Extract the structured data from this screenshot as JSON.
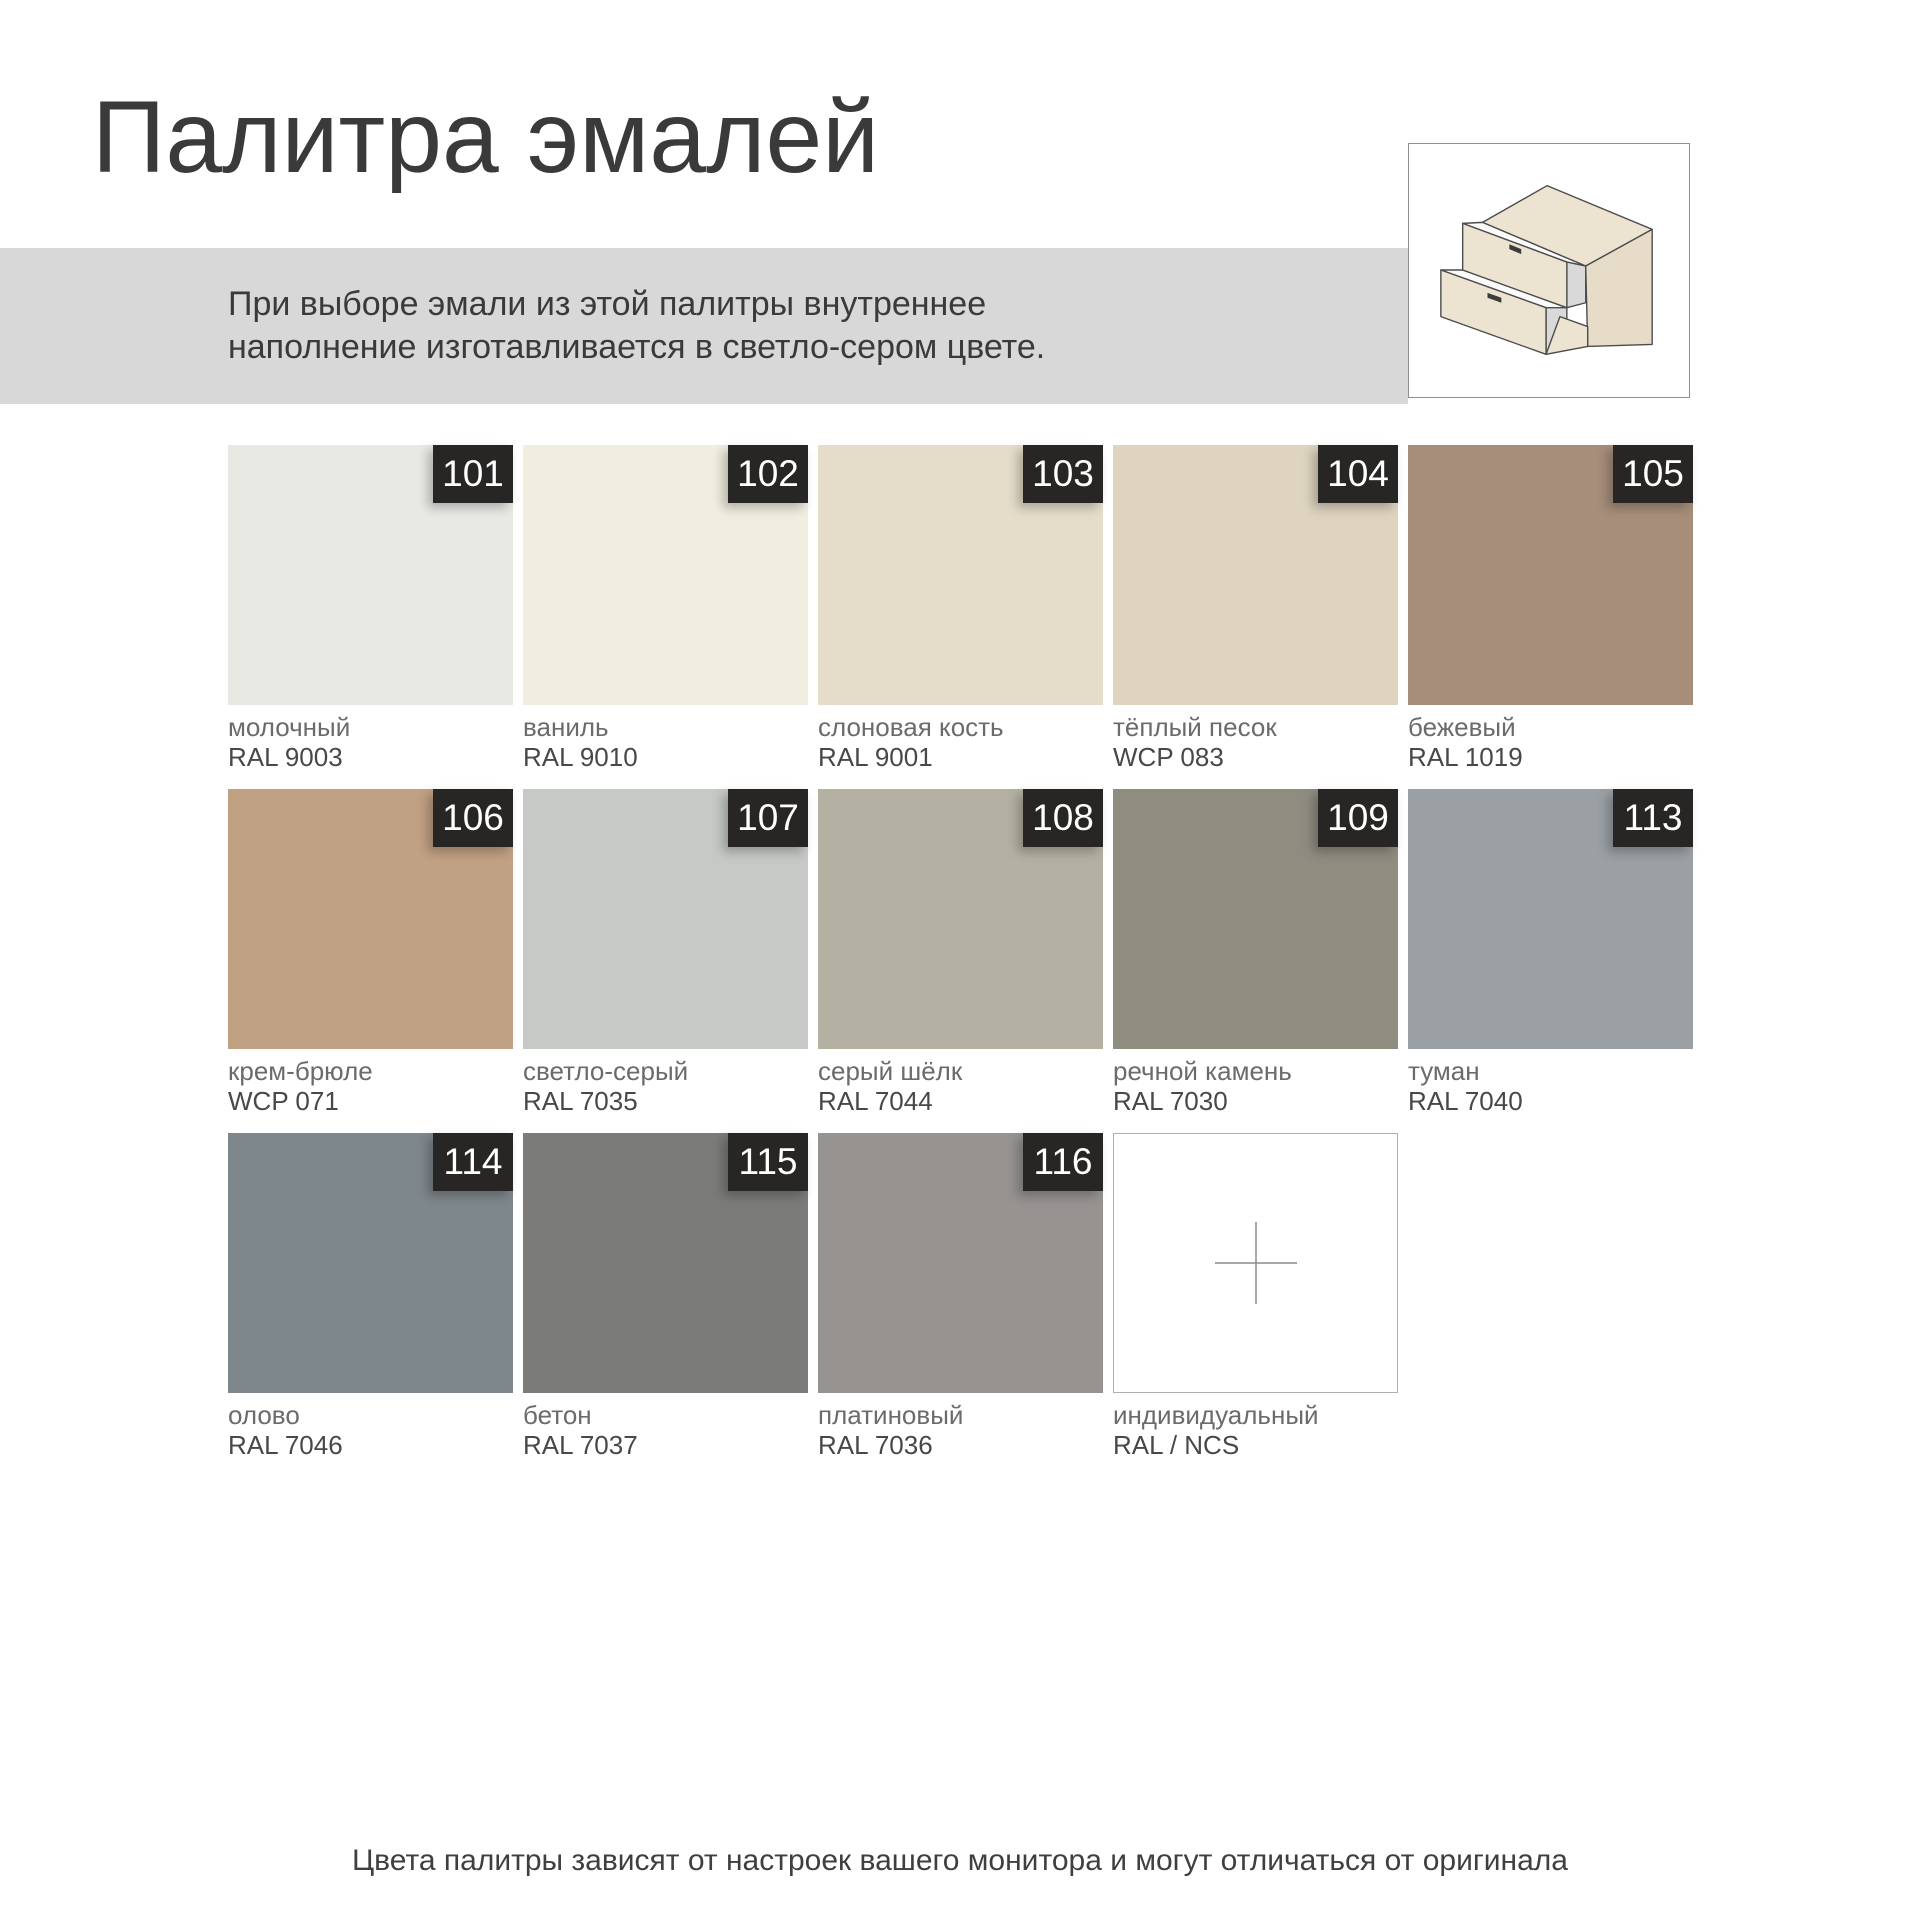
{
  "page": {
    "title": "Палитра эмалей",
    "note_line1": "При выборе эмали из этой палитры внутреннее",
    "note_line2": "наполнение изготавливается в светло-сером цвете.",
    "footer": "Цвета палитры зависят от настроек вашего монитора и могут отличаться от оригинала"
  },
  "colors": {
    "banner_bg": "#d8d8d8",
    "badge_bg": "#272625",
    "badge_text": "#ffffff",
    "title_text": "#3a3a3a",
    "name_text": "#6b6b6b",
    "code_text": "#484848",
    "custom_border": "#aeaeae",
    "plus_line": "#8a8a8a",
    "illustration_outline": "#4c4c4c",
    "illustration_wood": "#ece3d1"
  },
  "illustration": {
    "icon": "two-drawer-cabinet"
  },
  "swatches": [
    {
      "num": "101",
      "name": "молочный",
      "code": "RAL 9003",
      "hex": "#e9e9e4"
    },
    {
      "num": "102",
      "name": "ваниль",
      "code": "RAL 9010",
      "hex": "#f1ede1"
    },
    {
      "num": "103",
      "name": "слоновая кость",
      "code": "RAL 9001",
      "hex": "#e5ddca"
    },
    {
      "num": "104",
      "name": "тёплый песок",
      "code": "WCP 083",
      "hex": "#ded4bf"
    },
    {
      "num": "105",
      "name": "бежевый",
      "code": "RAL 1019",
      "hex": "#a68e7a"
    },
    {
      "num": "106",
      "name": "крем-брюле",
      "code": "WCP 071",
      "hex": "#c1a184"
    },
    {
      "num": "107",
      "name": "светло-серый",
      "code": "RAL 7035",
      "hex": "#c6c9c5"
    },
    {
      "num": "108",
      "name": "серый шёлк",
      "code": "RAL 7044",
      "hex": "#b4b1a3"
    },
    {
      "num": "109",
      "name": "речной камень",
      "code": "RAL 7030",
      "hex": "#8f8d80"
    },
    {
      "num": "113",
      "name": "туман",
      "code": "RAL 7040",
      "hex": "#9aa0a4"
    },
    {
      "num": "114",
      "name": "олово",
      "code": "RAL 7046",
      "hex": "#7e878c"
    },
    {
      "num": "115",
      "name": "бетон",
      "code": "RAL 7037",
      "hex": "#7b7b7a"
    },
    {
      "num": "116",
      "name": "платиновый",
      "code": "RAL 7036",
      "hex": "#969391"
    },
    {
      "num": null,
      "name": "индивидуальный",
      "code": "RAL / NCS",
      "hex": "#ffffff",
      "custom": true
    }
  ]
}
